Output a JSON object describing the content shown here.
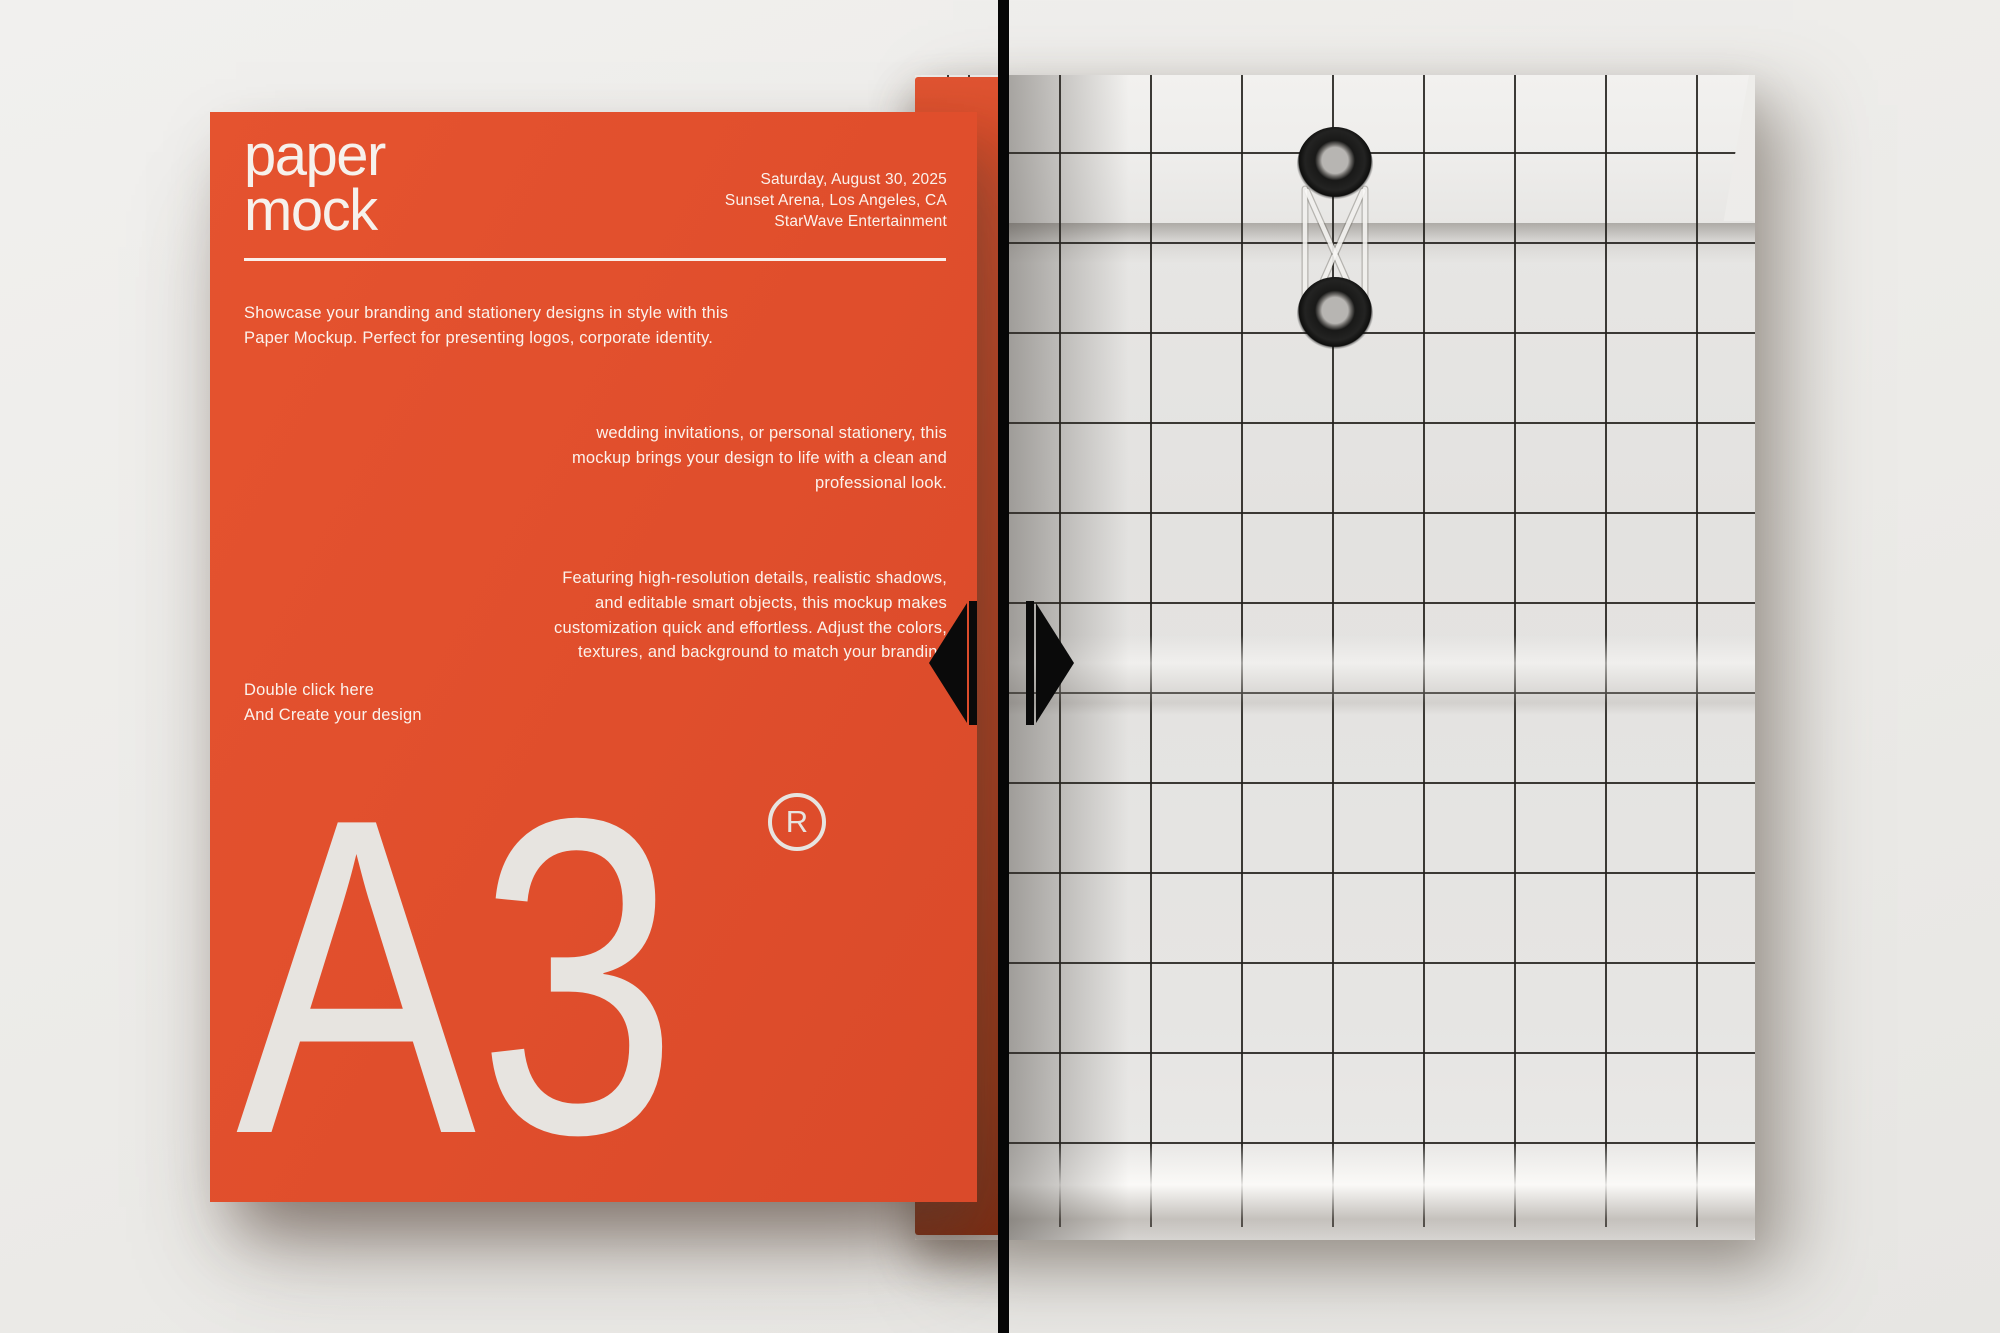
{
  "poster": {
    "logo": {
      "line1": "paper",
      "line2": "mock"
    },
    "event": {
      "lines": [
        "Saturday, August 30, 2025",
        "Sunset Arena, Los Angeles, CA",
        "StarWave Entertainment"
      ]
    },
    "intro": {
      "lines": [
        "Showcase your branding and stationery designs in style with this",
        "Paper Mockup. Perfect for presenting logos, corporate identity."
      ]
    },
    "continuation": {
      "lines": [
        "wedding invitations, or personal stationery, this",
        "mockup brings your design to life with a clean and",
        "professional look."
      ]
    },
    "features": {
      "lines": [
        "Featuring high-resolution details, realistic shadows,",
        "and editable smart objects, this mockup makes",
        "customization quick and effortless. Adjust the colors,",
        "textures, and background to match your branding"
      ]
    },
    "cta": {
      "lines": [
        "Double click here",
        "And Create your design"
      ]
    },
    "size_label": "A3",
    "registered_mark": "R"
  },
  "slider": {
    "left_arrow_icon": "triangle-left",
    "right_arrow_icon": "triangle-right"
  },
  "envelope": {
    "grommet_count": "2",
    "style": "string-tie wireframe grid"
  },
  "colors": {
    "poster_orange": "#e0512f",
    "envelope_orange_deep": "#8f2d10",
    "paper_white": "#eceae8",
    "grid_line": "#23211d",
    "divider_black": "#060606",
    "background_gray": "#ecebe8",
    "text_white": "#faf2ec"
  }
}
